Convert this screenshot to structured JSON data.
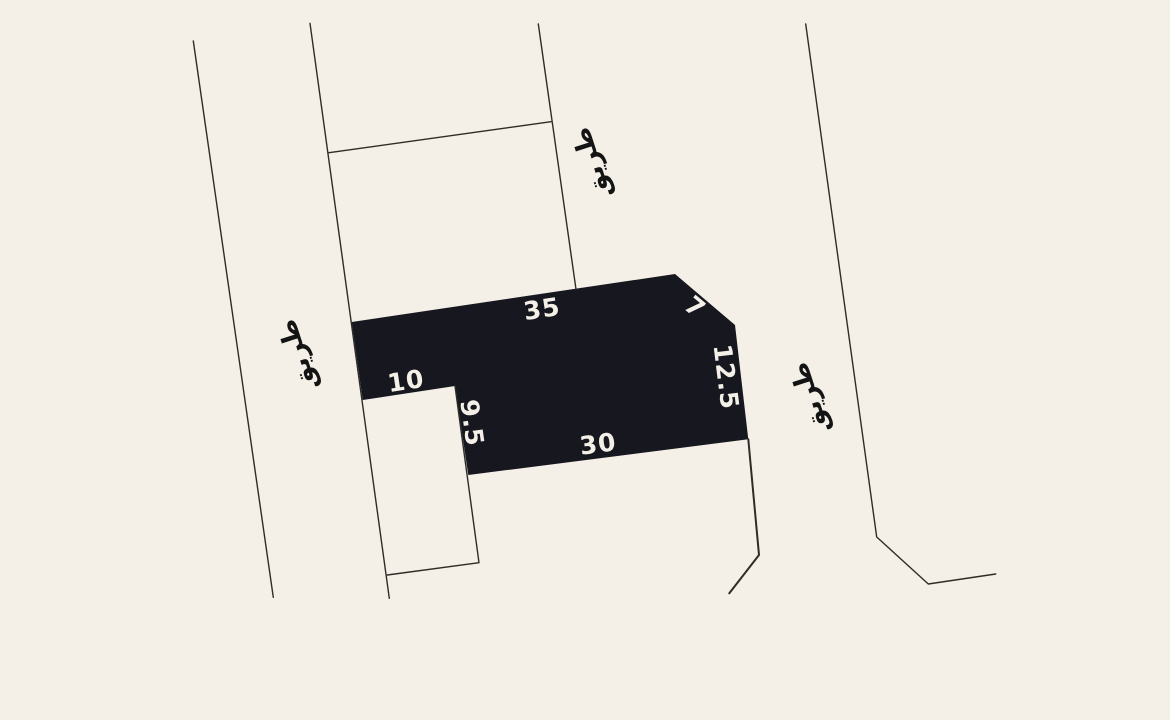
{
  "map": {
    "colors": {
      "background": "#f4f0e7",
      "parcel_fill": "#171720",
      "boundary_line": "#2e2c28",
      "dimension_text": "#f4f0e7",
      "road_text": "#141414"
    },
    "parcel": {
      "dimensions": {
        "top": "35",
        "bevel": "7",
        "right": "12.5",
        "bottom": "30",
        "notch_right": "9.5",
        "notch_top": "10"
      }
    },
    "road_labels": {
      "top": "طريق",
      "left": "طريق",
      "right": "طريق"
    }
  }
}
